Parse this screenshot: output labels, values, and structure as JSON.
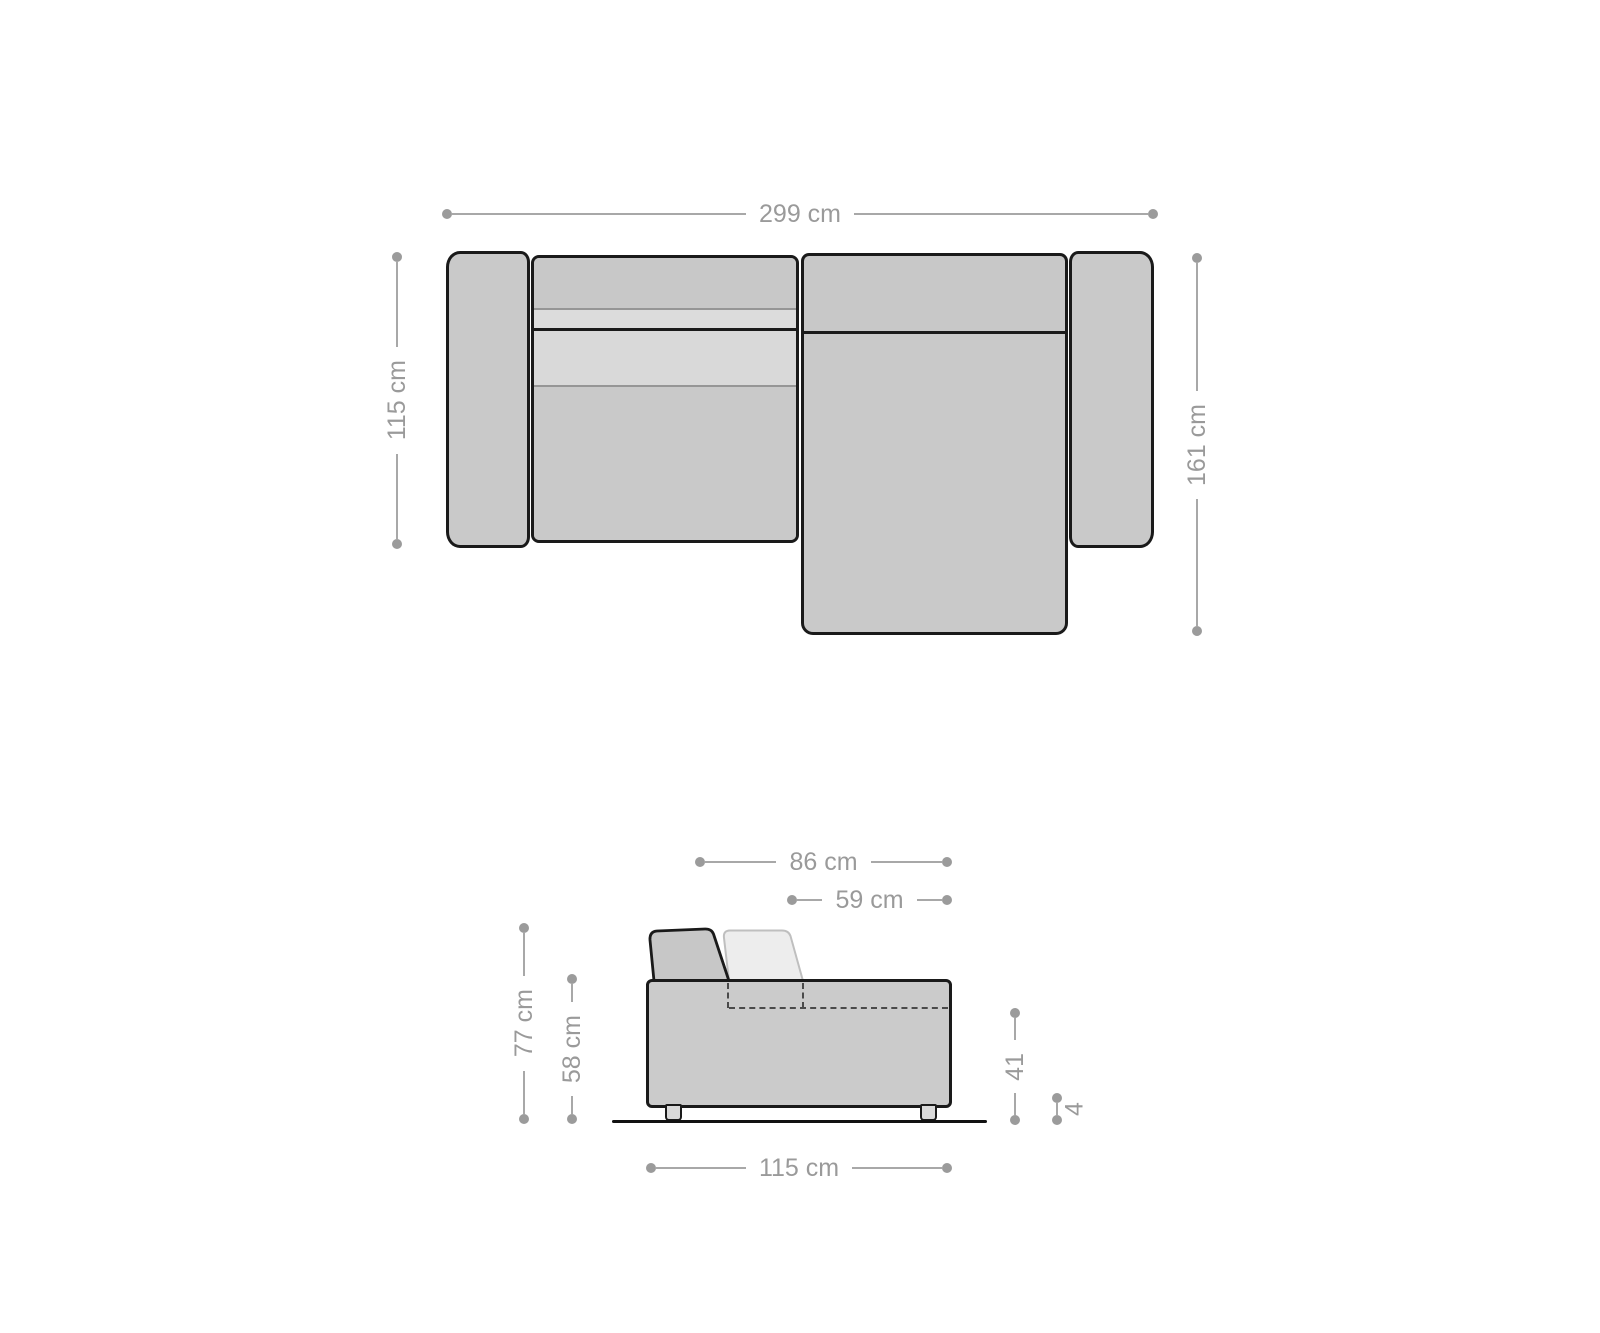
{
  "diagram": {
    "subject": "corner-sofa-with-recamiere",
    "colors": {
      "background": "#ffffff",
      "sofa_fill": "#c9c9c9",
      "sofa_back_fill": "#c8c8c8",
      "cushion_light_fill": "#dcdcdc",
      "reclined_cushion_fill": "#ededed",
      "outline": "#1a1a1a",
      "dimension_gray": "#9a9a9a"
    }
  },
  "top_view": {
    "dims": {
      "overall_width": "299 cm",
      "sofa_depth": "115 cm",
      "recamiere_depth": "161 cm"
    }
  },
  "side_view": {
    "dims": {
      "backrest_depth": "86 cm",
      "seat_depth": "59 cm",
      "total_height": "77 cm",
      "base_height": "58 cm",
      "seat_height": "41",
      "leg_height": "4",
      "side_depth": "115 cm"
    }
  }
}
